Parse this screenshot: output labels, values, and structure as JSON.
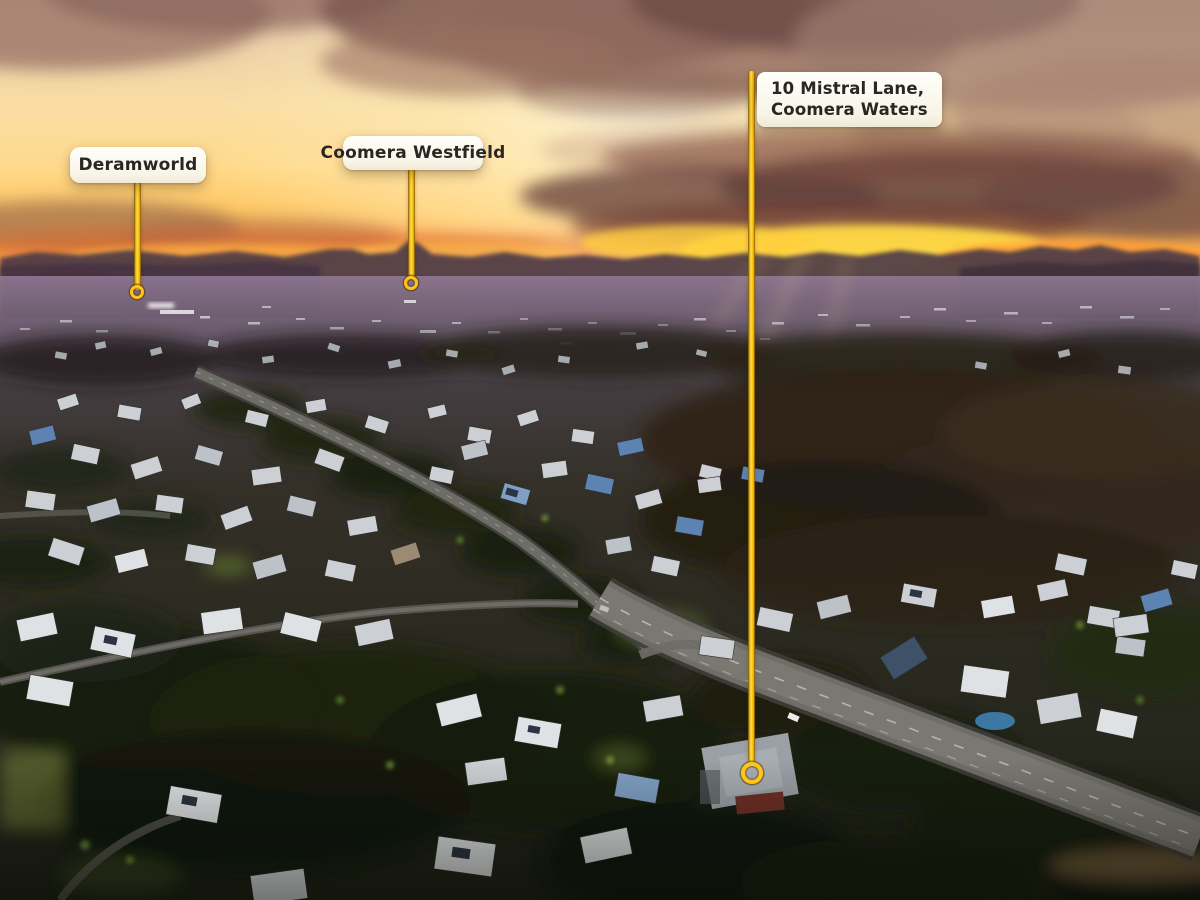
{
  "theme": {
    "accent_color": "#ffc414",
    "label_bg": "#f8f4e7",
    "label_text": "#2a2623"
  },
  "scene_colors": {
    "sky_glow": "#fff6dd",
    "sunset_orange": "#f58233",
    "mountain_silhouette": "#4e3a47",
    "dusk_suburb": "#2c2a20"
  },
  "annotations": [
    {
      "id": "deramworld",
      "label": "Deramworld"
    },
    {
      "id": "coomera-westfield",
      "label": "Coomera Westfield"
    },
    {
      "id": "mistral-lane",
      "lines": [
        "10 Mistral Lane,",
        "Coomera Waters"
      ]
    }
  ]
}
